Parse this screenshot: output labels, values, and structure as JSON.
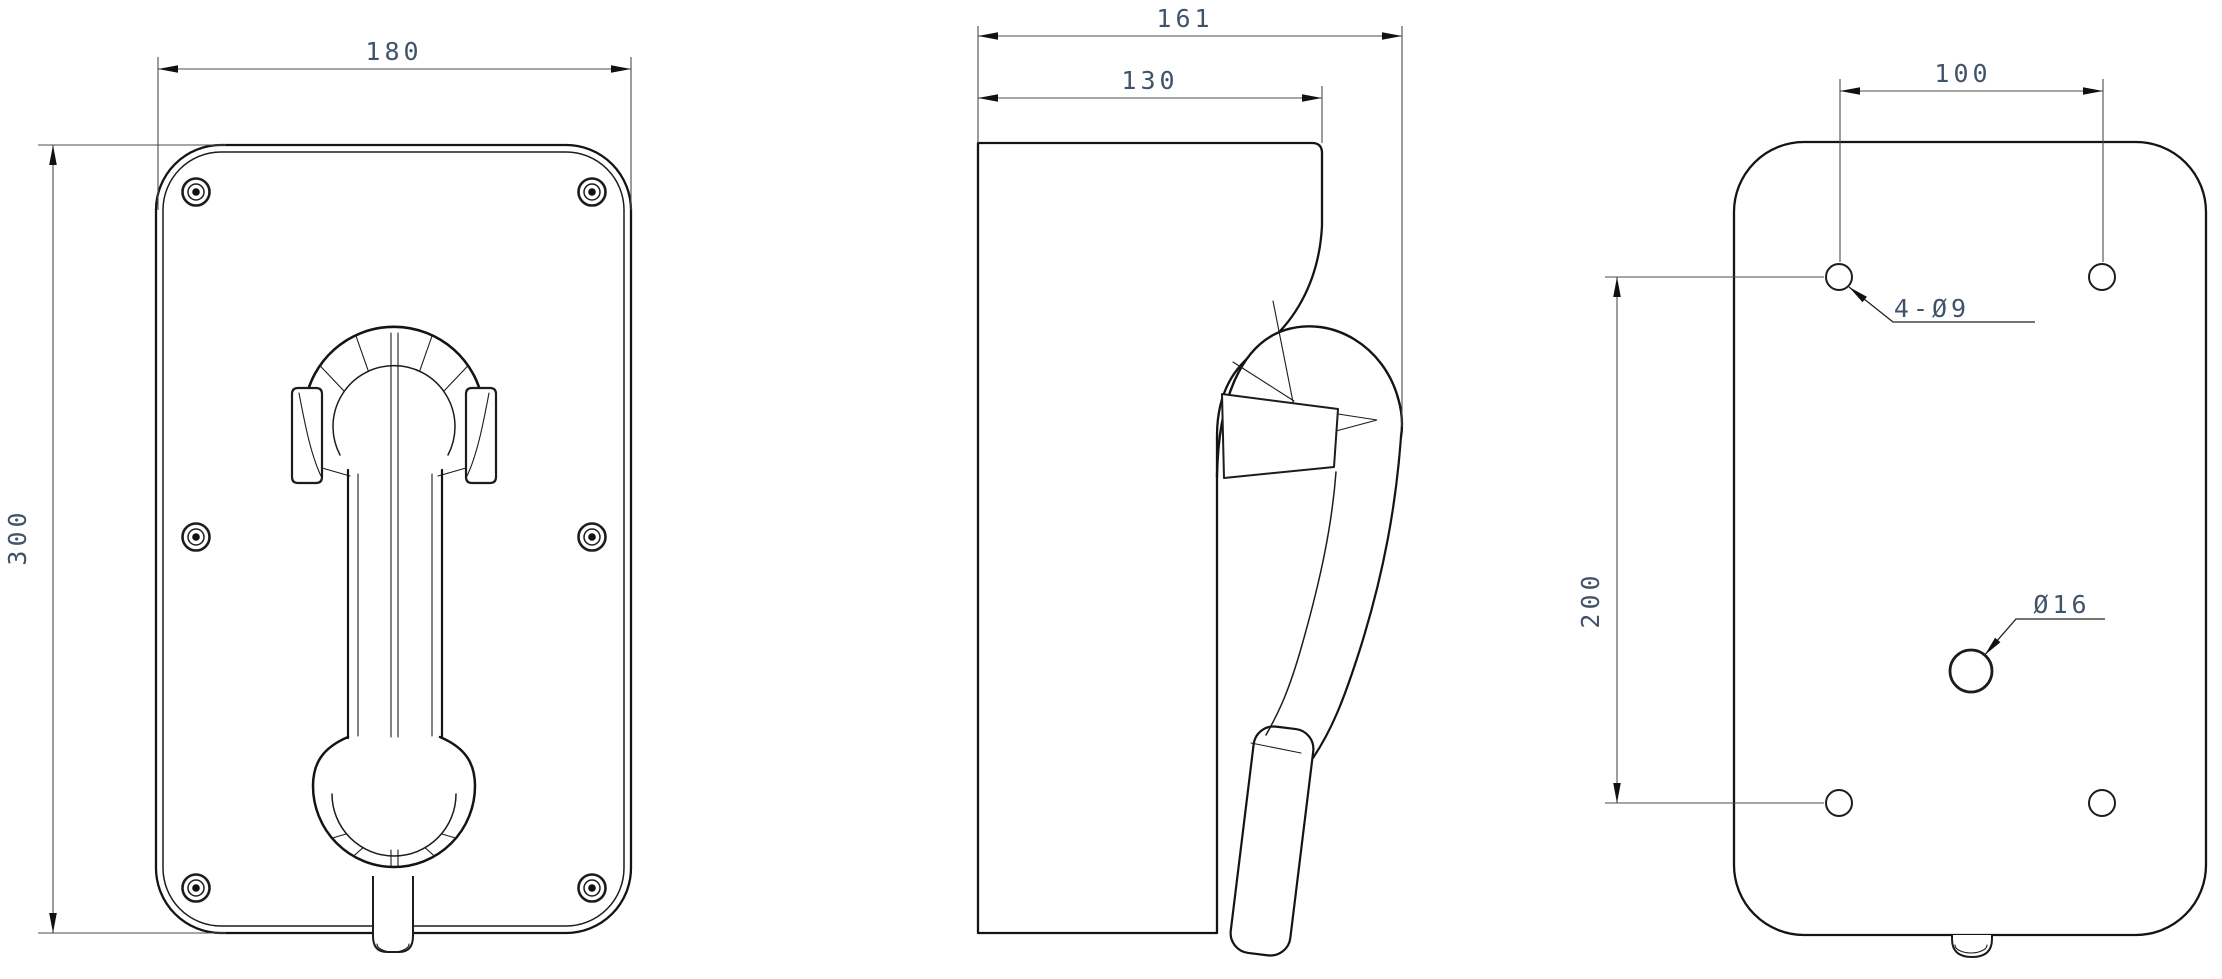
{
  "drawing": {
    "background": "#ffffff",
    "views": {
      "front": {
        "width_dim": "180",
        "height_dim": "300"
      },
      "side": {
        "total_depth_dim": "161",
        "body_depth_dim": "130"
      },
      "rear": {
        "hole_span_horizontal_dim": "100",
        "hole_span_vertical_dim": "200",
        "mounting_holes_label": "4-Ø9",
        "cable_hole_label": "Ø16"
      }
    },
    "style": {
      "object_line_color": "#141414",
      "dimension_line_color": "#4d4d4d",
      "dimension_text_color": "#41536a"
    }
  }
}
